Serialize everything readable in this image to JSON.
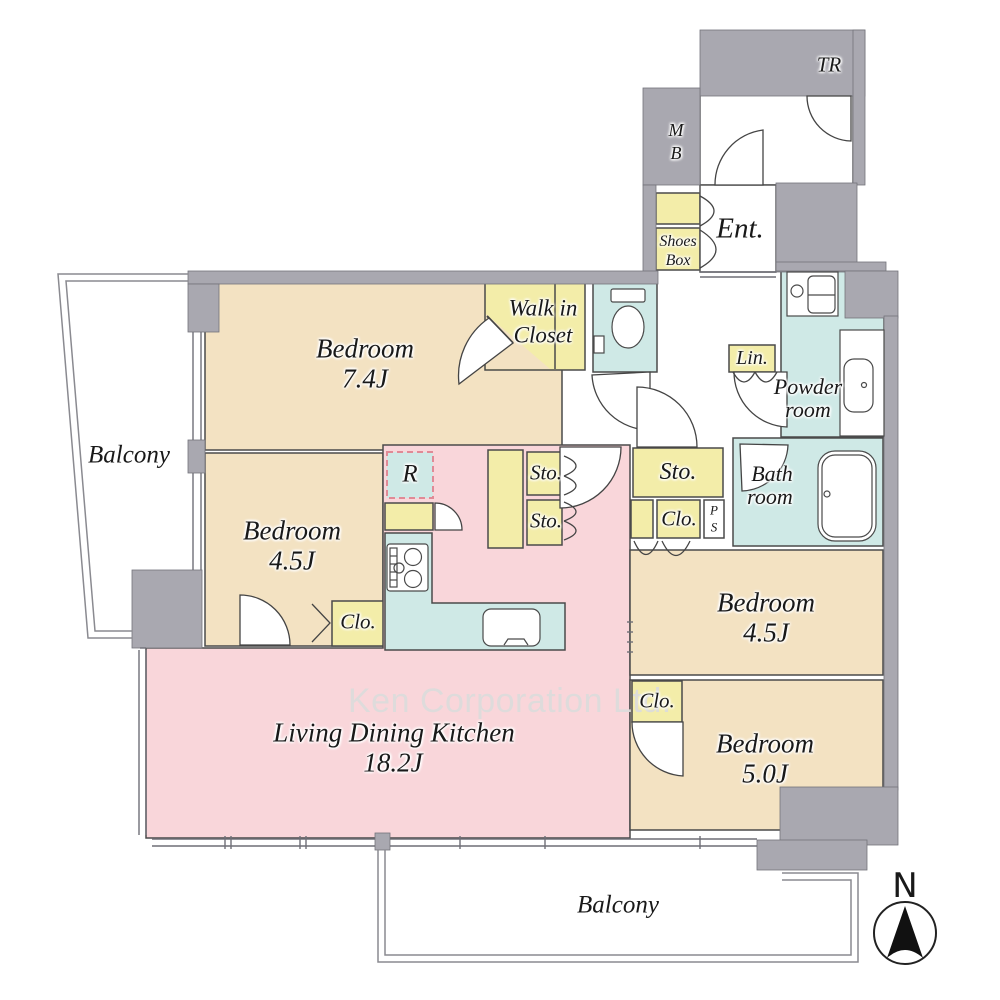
{
  "watermark": "Ken Corporation Ltd.",
  "compass": {
    "north_label": "N"
  },
  "rooms": {
    "bedroom_74": {
      "name": "Bedroom",
      "size": "7.4J"
    },
    "bedroom_45_left": {
      "name": "Bedroom",
      "size": "4.5J"
    },
    "bedroom_45_right": {
      "name": "Bedroom",
      "size": "4.5J"
    },
    "bedroom_50": {
      "name": "Bedroom",
      "size": "5.0J"
    },
    "ldk": {
      "name": "Living Dining Kitchen",
      "size": "18.2J"
    },
    "walk_in_closet": {
      "line1": "Walk in",
      "line2": "Closet"
    },
    "powder_room": {
      "line1": "Powder",
      "line2": "room"
    },
    "bath_room": {
      "line1": "Bath",
      "line2": "room"
    },
    "balcony_left": {
      "name": "Balcony"
    },
    "balcony_bottom": {
      "name": "Balcony"
    },
    "entrance": {
      "name": "Ent."
    },
    "trunk_room": {
      "name": "TR"
    },
    "meter_box": {
      "line1": "M",
      "line2": "B"
    },
    "shoes_box": {
      "line1": "Shoes",
      "line2": "Box"
    },
    "linen": {
      "name": "Lin."
    },
    "refrigerator": {
      "name": "R"
    },
    "pipe_space": {
      "line1": "P",
      "line2": "S"
    },
    "storage_kitchen_upper": {
      "name": "Sto."
    },
    "storage_kitchen_lower": {
      "name": "Sto."
    },
    "storage_hall": {
      "name": "Sto."
    },
    "closet_hall": {
      "name": "Clo."
    },
    "closet_bedroom_45_left": {
      "name": "Clo."
    },
    "closet_bedroom_50": {
      "name": "Clo."
    }
  },
  "palette": {
    "room_tan": "#f3e2c2",
    "room_pink": "#f9d6da",
    "room_cyan": "#cfe9e6",
    "room_yellow": "#f3eda9",
    "wall_gray": "#a9a8b0"
  }
}
